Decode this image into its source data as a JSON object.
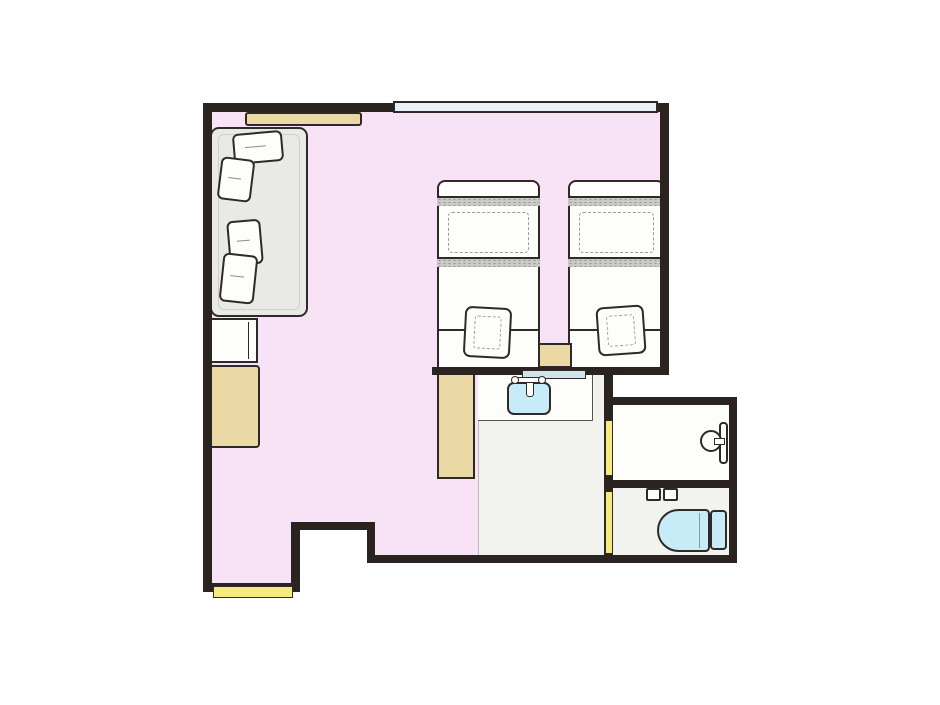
{
  "app": {
    "type": "floor-plan-illustration",
    "description": "Hotel twin room floor plan, top-down view, no text labels"
  },
  "palette": {
    "wall": "#2b2320",
    "outline": "#2f2a28",
    "bedroom_floor": "#f8e2f6",
    "washroom_floor": "#f1f1ee",
    "shower_floor": "#fdfdfa",
    "toilet_floor": "#f2f2ef",
    "wood": "#ead9a4",
    "door": "#f6e97e",
    "fixture": "#c7ebf7",
    "window": "#e6f2f4",
    "sofa": "#e9e9e7",
    "band": "#c9c9c6",
    "shelf": "#cfe4e8",
    "white": "#fdfdfc"
  },
  "rooms": [
    {
      "name": "bedroom",
      "floor": "pink"
    },
    {
      "name": "washroom-vanity",
      "floor": "light-gray"
    },
    {
      "name": "shower-room",
      "floor": "white"
    },
    {
      "name": "toilet-room",
      "floor": "light-gray"
    }
  ],
  "furniture": [
    "window",
    "wall-hanger-rack",
    "sofa",
    "sofa-pillows-x4",
    "side-table",
    "left-cabinet",
    "twin-bed-1",
    "twin-bed-2",
    "bed-cushion-x2",
    "nightstand",
    "mid-cabinet",
    "vanity-counter",
    "sink",
    "faucet",
    "shelf",
    "entrance-door",
    "shower-sliding-door",
    "toilet-sliding-door",
    "shower-fixture",
    "toilet",
    "toilet-control-buttons"
  ]
}
